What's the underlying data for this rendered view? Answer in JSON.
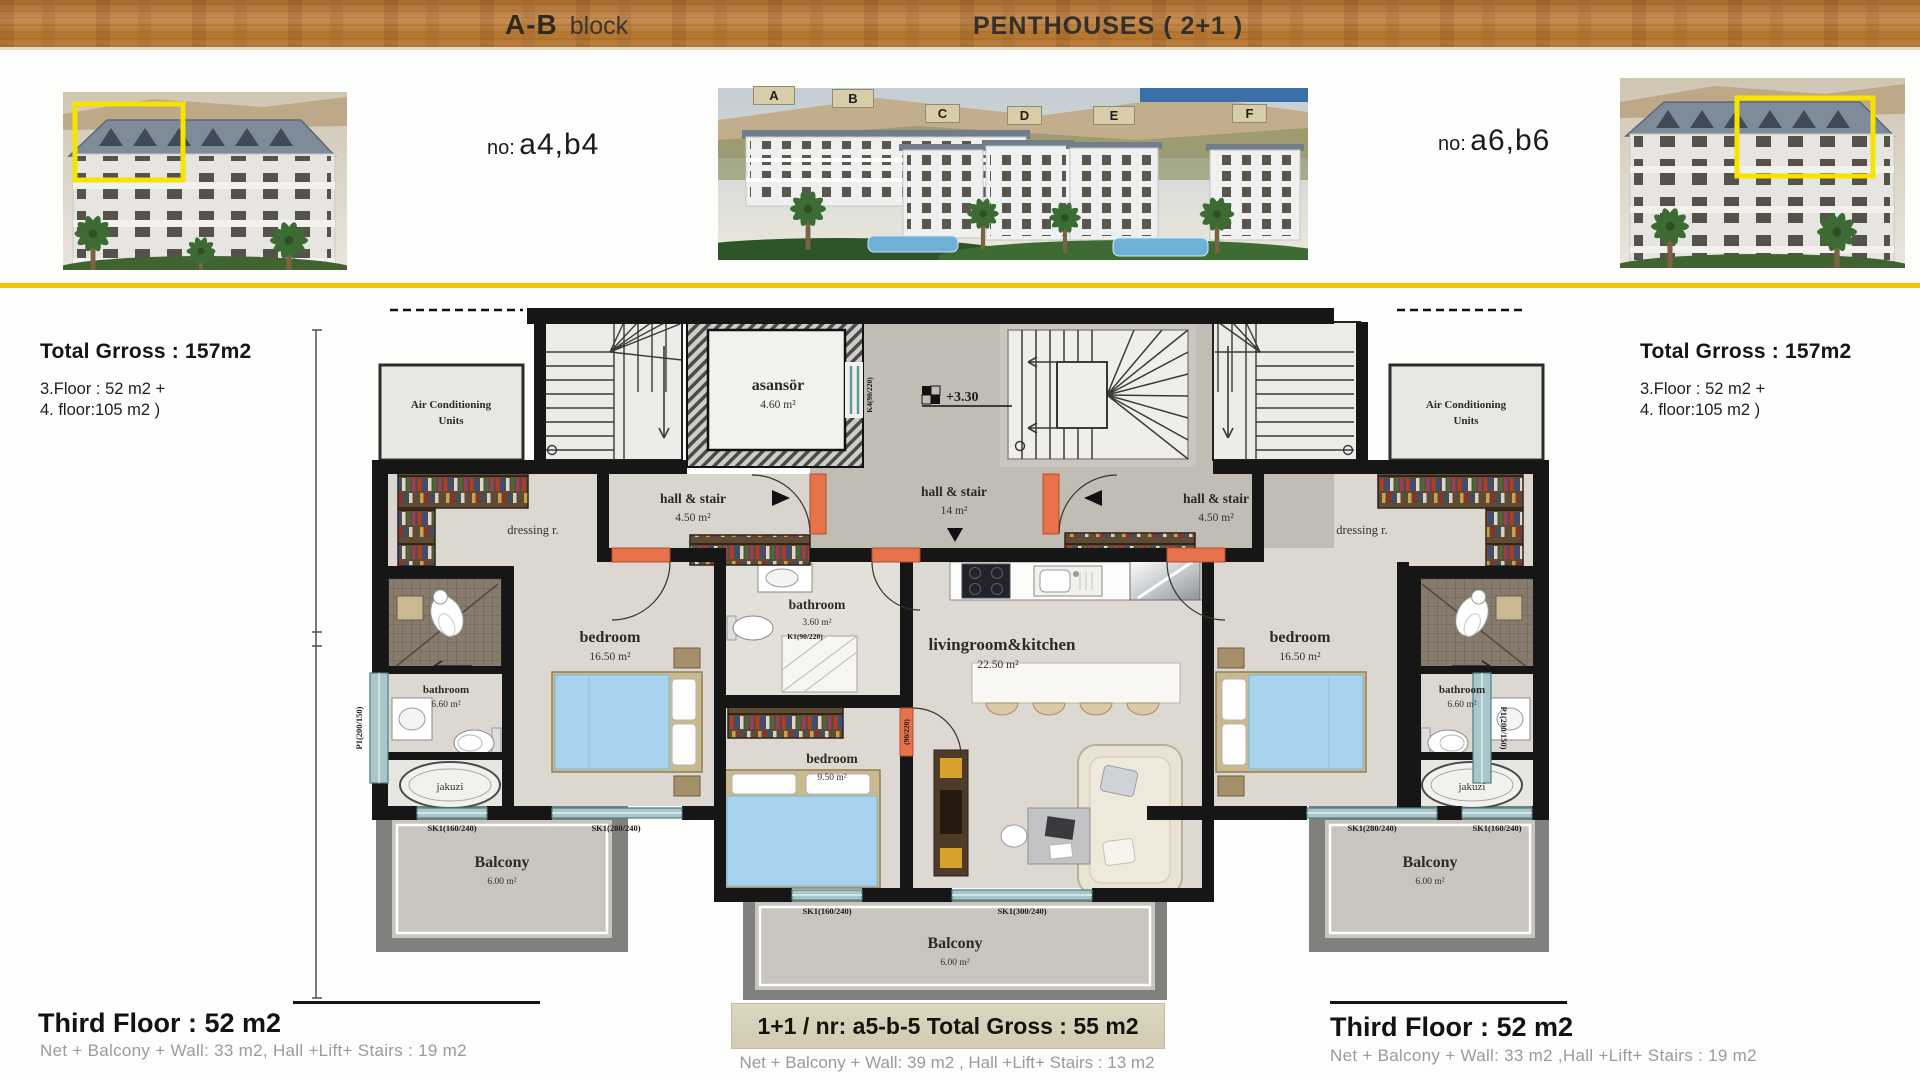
{
  "header": {
    "block_name": "A-B",
    "block_word": "block",
    "title": "PENTHOUSES  ( 2+1 )"
  },
  "units": {
    "left_label": "no:",
    "left_value": "a4,b4",
    "right_label": "no:",
    "right_value": "a6,b6"
  },
  "site_tags": [
    "A",
    "B",
    "C",
    "D",
    "E",
    "F"
  ],
  "summary_left": {
    "title": "Total Grross : 157m2",
    "line1": "3.Floor : 52 m2 +",
    "line2": "4. floor:105 m2 )"
  },
  "summary_right": {
    "title": "Total Grross : 157m2",
    "line1": "3.Floor : 52 m2 +",
    "line2": "4. floor:105 m2 )"
  },
  "plan": {
    "ac_units_line1": "Air Conditioning",
    "ac_units_line2": "Units",
    "elevator_name": "asansör",
    "elevator_area": "4.60 m²",
    "level_mark": "+3.30",
    "hall_side_name": "hall & stair",
    "hall_side_area": "4.50 m²",
    "hall_center_name": "hall & stair",
    "hall_center_area": "14  m²",
    "dressing": "dressing r.",
    "bedroom_big_name": "bedroom",
    "bedroom_big_area": "16.50 m²",
    "bedroom_small_name": "bedroom",
    "bedroom_small_area": "9.50 m²",
    "bathroom_center_name": "bathroom",
    "bathroom_center_area": "3.60 m²",
    "bathroom_side_name": "bathroom",
    "bathroom_side_area": "6.60 m²",
    "jakuzi": "jakuzi",
    "living_name": "livingroom&kitchen",
    "living_area": "22.50 m²",
    "balcony_name": "Balcony",
    "balcony_area": "6.00 m²",
    "win_sk160": "SK1(160/240)",
    "win_sk280": "SK1(280/240)",
    "win_sk300": "SK1(300/240)",
    "win_p1": "P1(200/150)",
    "door_k1": "K1(90/220)",
    "door_90": "(90/220)",
    "door_k4": "K4(90/220)"
  },
  "footer_left": {
    "title": "Third Floor : 52 m2",
    "subtitle": "Net + Balcony + Wall: 33 m2, Hall +Lift+ Stairs  : 19 m2"
  },
  "footer_center": {
    "title": "1+1  / nr:  a5-b-5 Total Gross : 55 m2",
    "subtitle": "Net + Balcony + Wall: 39 m2  , Hall +Lift+ Stairs  : 13 m2"
  },
  "footer_right": {
    "title": "Third Floor : 52 m2",
    "subtitle": "Net + Balcony + Wall: 33 m2 ,Hall +Lift+ Stairs : 19 m2"
  }
}
